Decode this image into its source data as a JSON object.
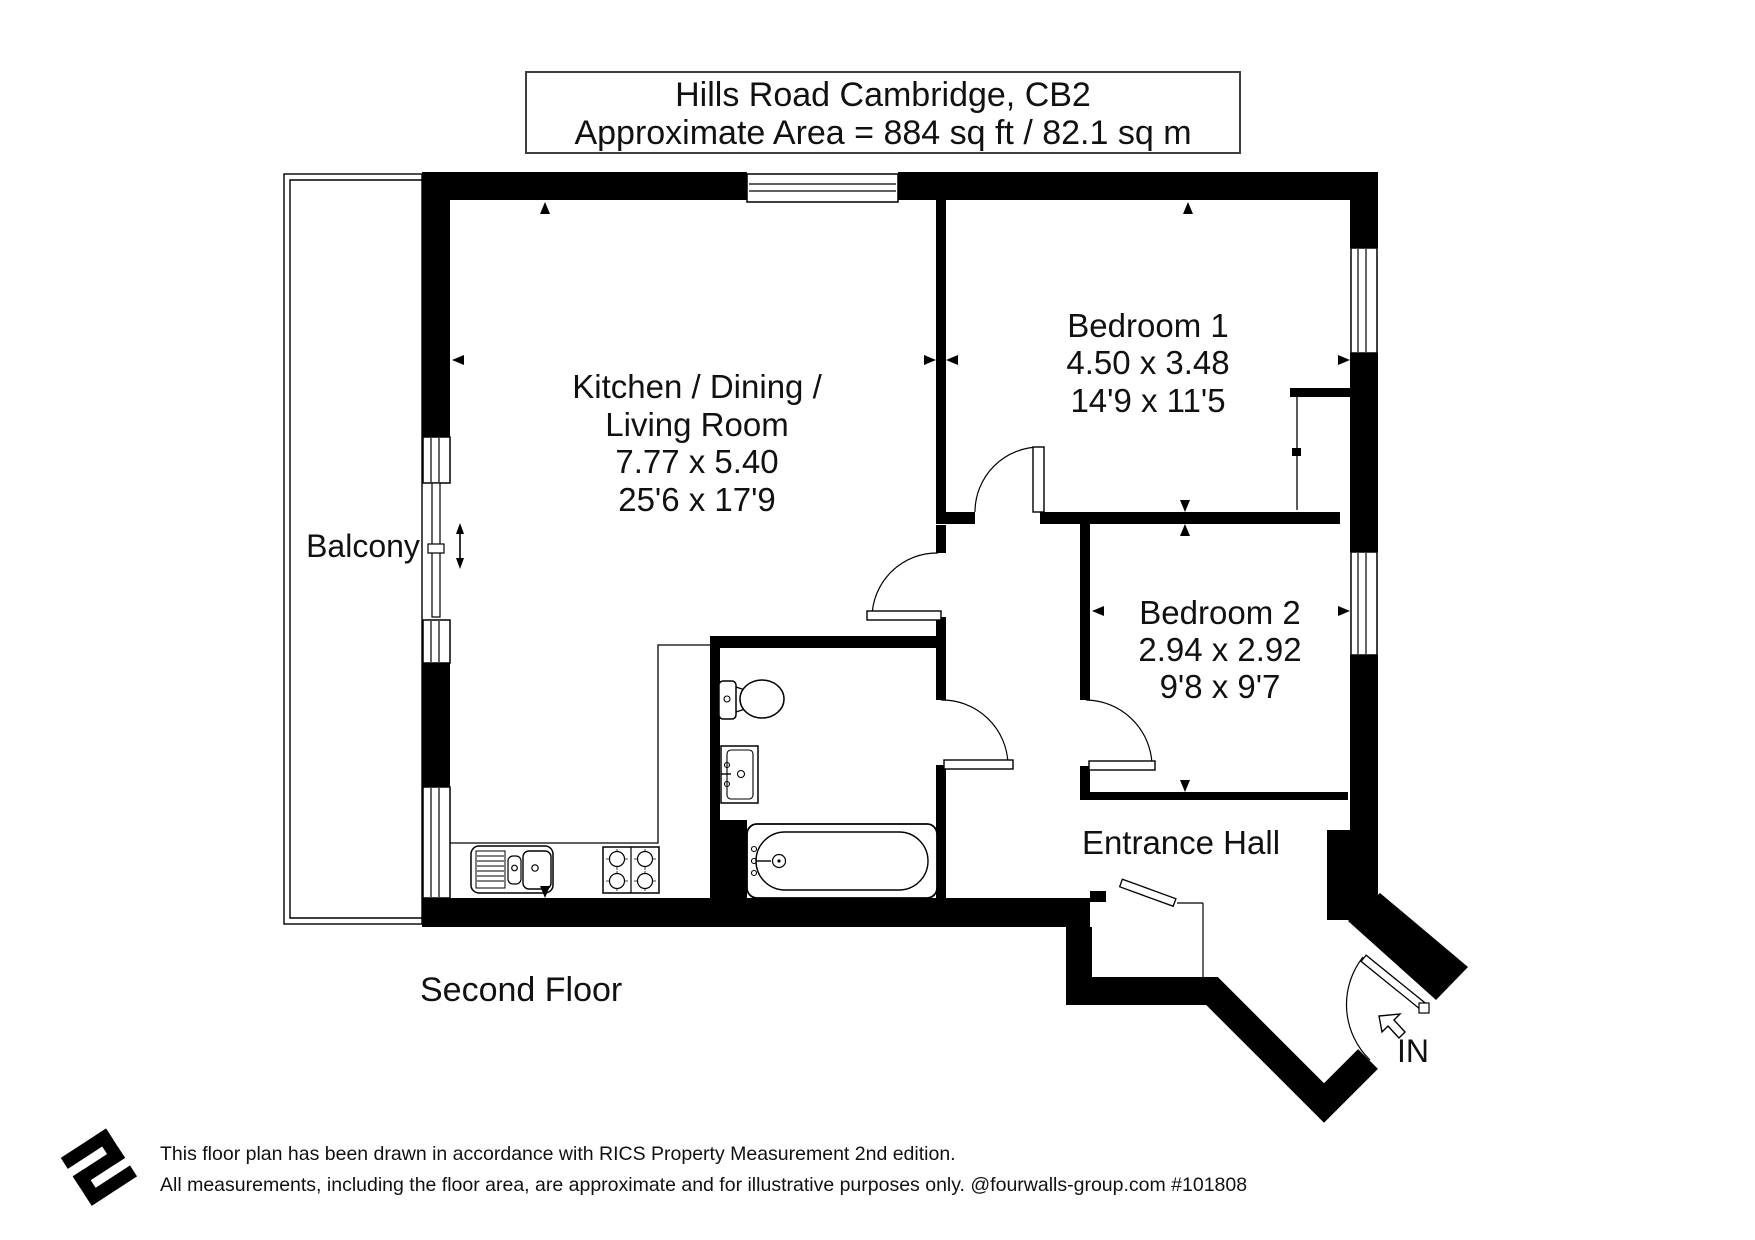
{
  "title": {
    "line1": "Hills Road Cambridge, CB2",
    "line2": "Approximate Area = 884 sq ft / 82.1 sq m"
  },
  "rooms": {
    "living": {
      "name_line1": "Kitchen / Dining /",
      "name_line2": "Living Room",
      "dims_m": "7.77 x 5.40",
      "dims_ft": "25'6 x 17'9"
    },
    "bedroom1": {
      "name": "Bedroom 1",
      "dims_m": "4.50 x 3.48",
      "dims_ft": "14'9 x 11'5"
    },
    "bedroom2": {
      "name": "Bedroom 2",
      "dims_m": "2.94 x 2.92",
      "dims_ft": "9'8 x 9'7"
    }
  },
  "balcony": {
    "label": "Balcony"
  },
  "entrance": {
    "label": "Entrance Hall",
    "in_label": "IN"
  },
  "floor_label": "Second Floor",
  "footer": {
    "line1": "This floor plan has been drawn in accordance with RICS Property Measurement 2nd edition.",
    "line2": "All measurements, including the floor area, are approximate and for illustrative purposes only. @fourwalls-group.com #101808"
  },
  "colors": {
    "wall": "#000000",
    "text": "#111111",
    "background": "#ffffff",
    "box_border": "#3f3f3f"
  }
}
